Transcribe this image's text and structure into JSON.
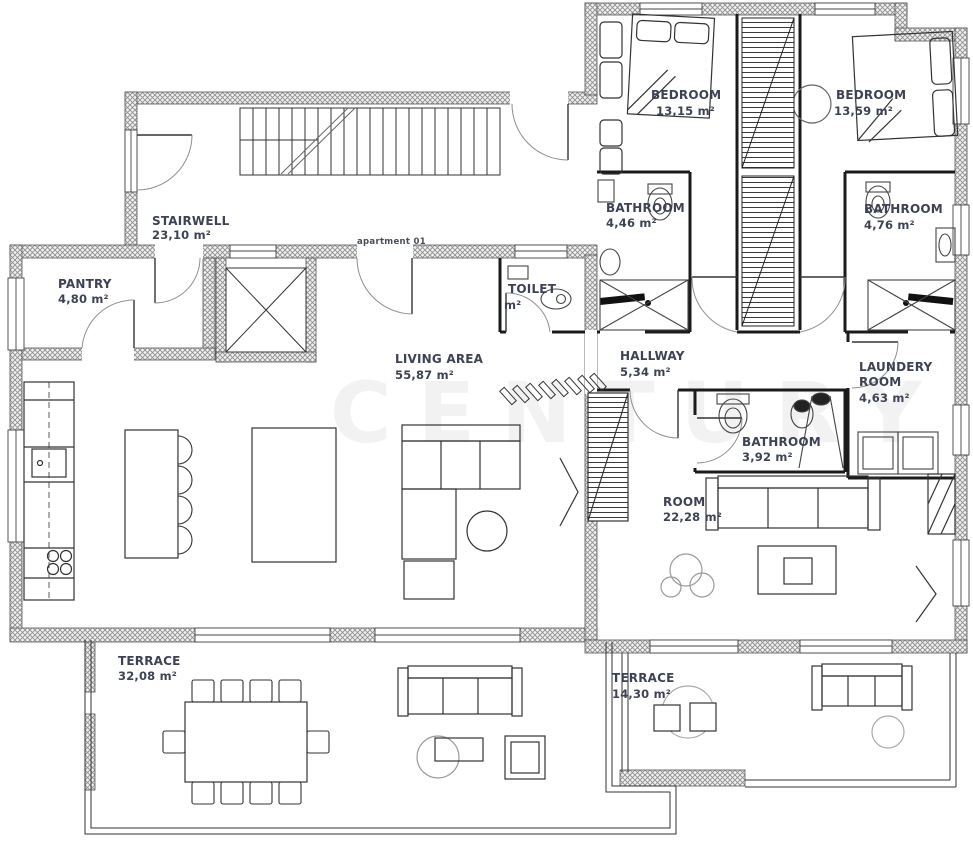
{
  "meta": {
    "apartment_label": "apartment 01",
    "watermark": "CENTURY"
  },
  "colors": {
    "label": "#3d4254",
    "wall_hatch": "#9a9a9a",
    "line": "#333333"
  },
  "rooms": [
    {
      "id": "stairwell",
      "name": "STAIRWELL",
      "area": "23,10 m²"
    },
    {
      "id": "pantry",
      "name": "PANTRY",
      "area": "4,80 m²"
    },
    {
      "id": "toilet",
      "name": "TOILET",
      "area": "m²"
    },
    {
      "id": "living-area",
      "name": "LIVING AREA",
      "area": "55,87 m²"
    },
    {
      "id": "hallway",
      "name": "HALLWAY",
      "area": "5,34 m²"
    },
    {
      "id": "bedroom-1",
      "name": "BEDROOM",
      "area": "13,15 m²"
    },
    {
      "id": "bedroom-2",
      "name": "BEDROOM",
      "area": "13,59 m²"
    },
    {
      "id": "bathroom-1",
      "name": "BATHROOM",
      "area": "4,46 m²"
    },
    {
      "id": "bathroom-2",
      "name": "BATHROOM",
      "area": "4,76 m²"
    },
    {
      "id": "laundry-room",
      "name": "LAUNDERY ROOM",
      "name_lines": [
        "LAUNDERY",
        "ROOM"
      ],
      "area": "4,63 m²"
    },
    {
      "id": "bathroom-3",
      "name": "BATHROOM",
      "area": "3,92 m²"
    },
    {
      "id": "room",
      "name": "ROOM",
      "area": "22,28 m²"
    },
    {
      "id": "terrace-1",
      "name": "TERRACE",
      "area": "32,08 m²"
    },
    {
      "id": "terrace-2",
      "name": "TERRACE",
      "area": "14,30 m²"
    }
  ]
}
